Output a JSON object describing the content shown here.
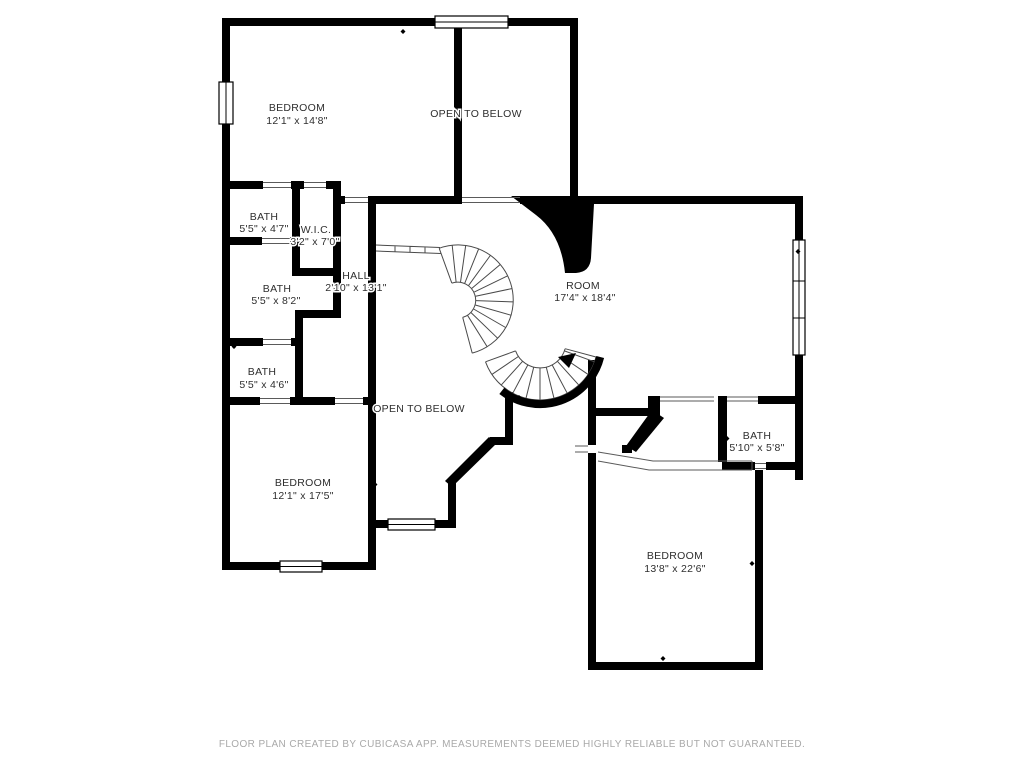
{
  "plan": {
    "type": "floor-plan",
    "creator_note": "CubiCasa",
    "colors": {
      "background": "#ffffff",
      "wall": "#000000",
      "stair_line": "#4a4a4a",
      "label_text": "#2e2e2e",
      "footer_text": "#a9a9a9"
    }
  },
  "rooms": {
    "bedroom_top_left": {
      "label": "BEDROOM",
      "dims": "12'1\" x 14'8\""
    },
    "open_below_top": {
      "label": "OPEN TO BELOW"
    },
    "bath_top": {
      "label": "BATH",
      "dims": "5'5\" x 4'7\""
    },
    "wic": {
      "label": "W.I.C.",
      "dims": "3'2\" x 7'0\""
    },
    "bath_mid": {
      "label": "BATH",
      "dims": "5'5\" x 8'2\""
    },
    "hall": {
      "label": "HALL",
      "dims": "2'10\" x 13'1\""
    },
    "bath_low": {
      "label": "BATH",
      "dims": "5'5\" x 4'6\""
    },
    "room": {
      "label": "ROOM",
      "dims": "17'4\" x 18'4\""
    },
    "open_below_mid": {
      "label": "OPEN TO BELOW"
    },
    "bedroom_bottom_left": {
      "label": "BEDROOM",
      "dims": "12'1\" x 17'5\""
    },
    "bath_bottom_right": {
      "label": "BATH",
      "dims": "5'10\" x 5'8\""
    },
    "bedroom_bottom_right": {
      "label": "BEDROOM",
      "dims": "13'8\" x 22'6\""
    }
  },
  "footer": {
    "text": "FLOOR PLAN CREATED BY CUBICASA APP. MEASUREMENTS DEEMED HIGHLY RELIABLE BUT NOT GUARANTEED."
  }
}
